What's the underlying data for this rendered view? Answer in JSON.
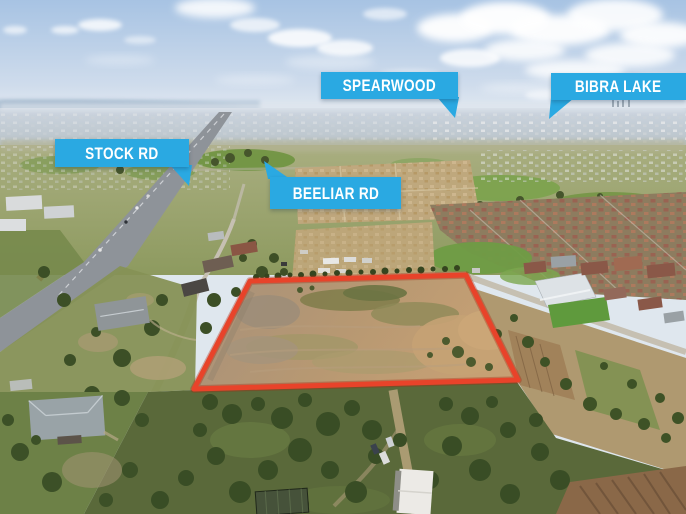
{
  "callouts": [
    {
      "id": "spearwood",
      "text": "SPEARWOOD"
    },
    {
      "id": "bibra-lake",
      "text": "BIBRA LAKE"
    },
    {
      "id": "stock-rd",
      "text": "STOCK RD"
    },
    {
      "id": "beeliar-rd",
      "text": "BEELIAR RD"
    }
  ],
  "colors": {
    "callout_bg": "#2aa9e2",
    "callout_text": "#ffffff",
    "boundary_outline": "#e8432a"
  }
}
